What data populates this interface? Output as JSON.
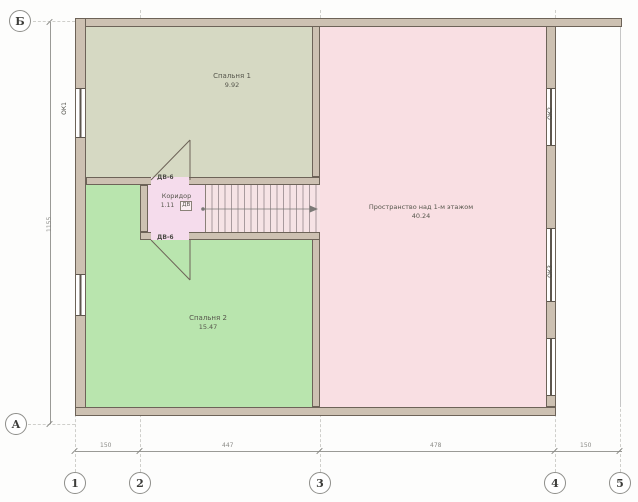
{
  "plan": {
    "grid": {
      "rows": [
        {
          "label": "Б"
        },
        {
          "label": "А"
        }
      ],
      "cols": [
        {
          "label": "1"
        },
        {
          "label": "2"
        },
        {
          "label": "3"
        },
        {
          "label": "4"
        },
        {
          "label": "5"
        }
      ]
    },
    "dims": {
      "bottom": [
        {
          "value": "150"
        },
        {
          "value": "447"
        },
        {
          "value": "478"
        },
        {
          "value": "150"
        }
      ],
      "left": {
        "value": "1155"
      }
    },
    "rooms": [
      {
        "name": "Спальня 1",
        "area": "9.92"
      },
      {
        "name": "Спальня 2",
        "area": "15.47"
      },
      {
        "name": "Пространство над 1-м этажом",
        "area": "40.24"
      },
      {
        "name": "Коридор",
        "area": "1.11"
      }
    ],
    "doors": {
      "top": "ДВ-6",
      "bottom": "ДВ-6",
      "tag": "ДВ"
    },
    "windows": {
      "left1": "ОК1",
      "right1": "ОК2",
      "right2": "ОК3"
    },
    "colors": {
      "room_top": "#d6d9c3",
      "room_green": "#b9e5ae",
      "room_pink": "#f9dfe3",
      "corridor": "#f5dcec",
      "stairs_bg": "#f6e3e5",
      "wall_fill": "#cdc1b2",
      "wall_edge": "#6d6358"
    }
  }
}
